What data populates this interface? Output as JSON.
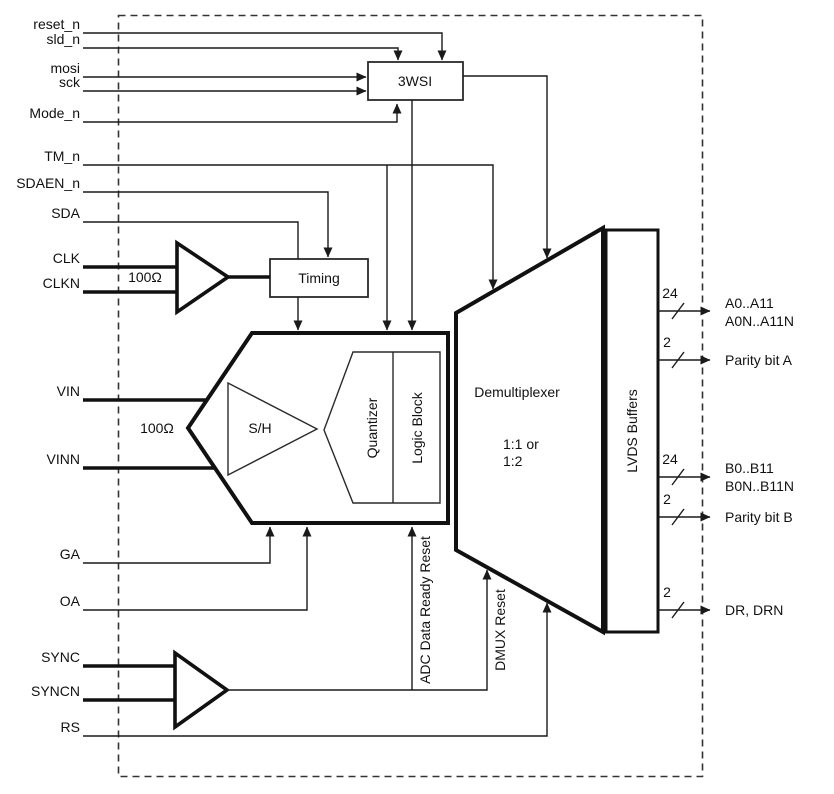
{
  "diagram": {
    "colors": {
      "line": "#1a1a1a",
      "background": "#ffffff"
    },
    "inputs": {
      "reset_n": "reset_n",
      "sld_n": "sld_n",
      "mosi": "mosi",
      "sck": "sck",
      "mode_n": "Mode_n",
      "tm_n": "TM_n",
      "sdaen_n": "SDAEN_n",
      "sda": "SDA",
      "clk": "CLK",
      "clkn": "CLKN",
      "vin": "VIN",
      "vinn": "VINN",
      "ga": "GA",
      "oa": "OA",
      "sync": "SYNC",
      "syncn": "SYNCN",
      "rs": "RS"
    },
    "blocks": {
      "serial_interface": "3WSI",
      "timing": "Timing",
      "sample_hold": "S/H",
      "quantizer": "Quantizer",
      "logic_block": "Logic Block",
      "demultiplexer": "Demultiplexer",
      "demux_mode_line1": "1:1 or",
      "demux_mode_line2": "1:2",
      "lvds_buffers": "LVDS Buffers"
    },
    "annotations": {
      "clk_termination": "100Ω",
      "vin_termination": "100Ω",
      "adc_data_ready_reset": "ADC Data Ready Reset",
      "dmux_reset": "DMUX Reset"
    },
    "outputs": [
      {
        "bus_width": "24",
        "line1": "A0..A11",
        "line2": "A0N..A11N"
      },
      {
        "bus_width": "2",
        "line1": "Parity bit A"
      },
      {
        "bus_width": "24",
        "line1": "B0..B11",
        "line2": "B0N..B11N"
      },
      {
        "bus_width": "2",
        "line1": "Parity bit B"
      },
      {
        "bus_width": "2",
        "line1": "DR, DRN"
      }
    ]
  }
}
